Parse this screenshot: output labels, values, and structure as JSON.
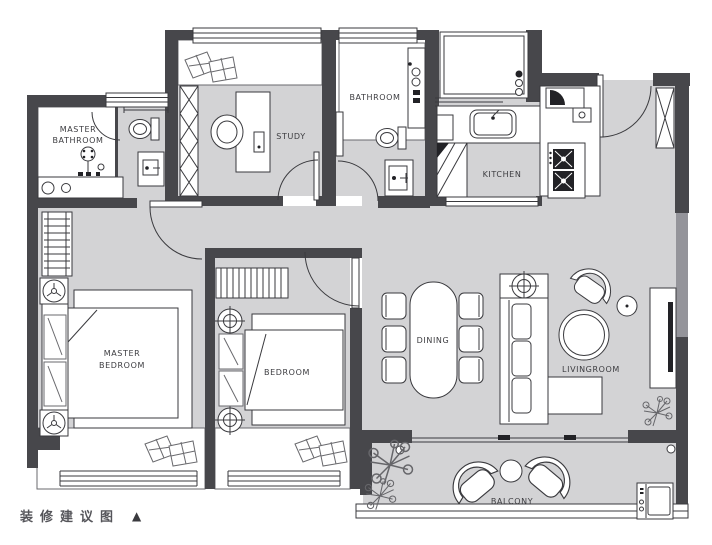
{
  "caption": {
    "text": "装修建议图",
    "marker": "▲"
  },
  "rooms": {
    "master_bathroom": {
      "line1": "MASTER",
      "line2": "BATHROOM"
    },
    "study": {
      "label": "STUDY"
    },
    "bathroom": {
      "label": "BATHROOM"
    },
    "kitchen": {
      "label": "KITCHEN"
    },
    "master_bedroom": {
      "line1": "MASTER",
      "line2": "BEDROOM"
    },
    "bedroom": {
      "label": "BEDROOM"
    },
    "dining": {
      "label": "DINING"
    },
    "livingroom": {
      "label": "LIVINGROOM"
    },
    "balcony": {
      "label": "BALCONY"
    }
  },
  "colors": {
    "wall": "#47474b",
    "wall_light": "#94949a",
    "floor": "#d3d3d5",
    "outline": "#3a3a3e",
    "label": "#3c3c40",
    "background": "#ffffff"
  }
}
